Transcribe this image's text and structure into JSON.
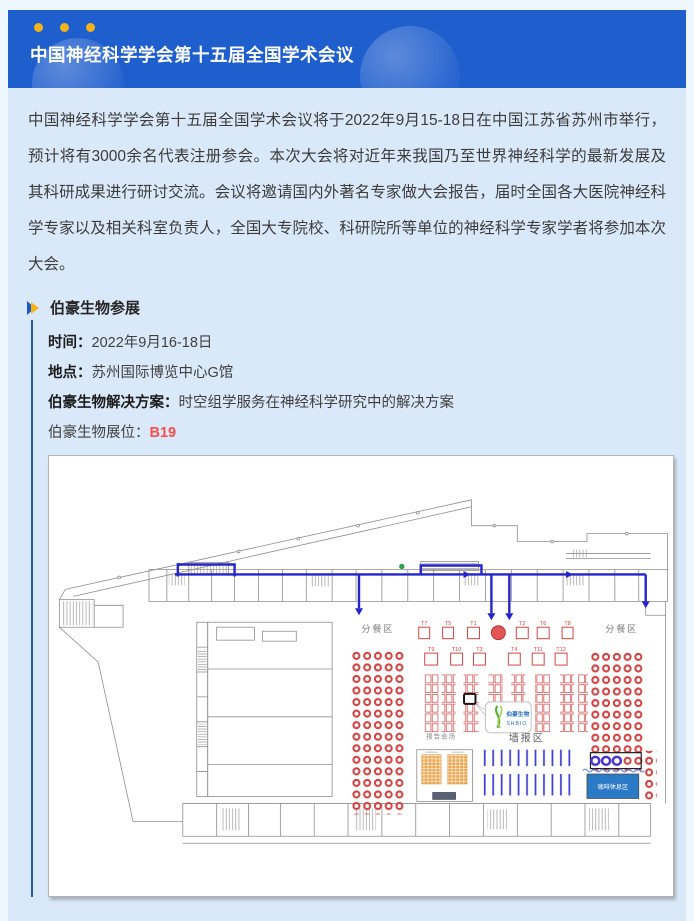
{
  "header": {
    "title": "中国神经科学学会第十五届全国学术会议"
  },
  "intro": {
    "text": "中国神经科学学会第十五届全国学术会议将于2022年9月15-18日在中国江苏省苏州市举行，预计将有3000余名代表注册参会。本次大会将对近年来我国乃至世界神经科学的最新发展及其科研成果进行研讨交流。会议将邀请国内外著名专家做大会报告，届时全国各大医院神经科学专家以及相关科室负责人，全国大专院校、科研院所等单位的神经科学专家学者将参加本次大会。"
  },
  "section": {
    "heading": "伯豪生物参展",
    "rows": [
      {
        "label": "时间：",
        "value": "2022年9月16-18日"
      },
      {
        "label": "地点：",
        "value": "苏州国际博览中心G馆"
      },
      {
        "label": "伯豪生物解决方案：",
        "value": "时空组学服务在神经科学研究中的解决方案"
      },
      {
        "label": "伯豪生物展位：",
        "value": "B19"
      }
    ]
  },
  "map": {
    "labels": {
      "dining_left": "分餐区",
      "dining_right": "分餐区",
      "lecture_hall": "报告会场",
      "poster_area": "墙报区",
      "coffee_area": "咖啡休息区"
    },
    "booth_row1": [
      "T7",
      "T5",
      "T1",
      "T2",
      "T6",
      "T8"
    ],
    "booth_row2": [
      "T9",
      "T10",
      "T3",
      "T4",
      "T11",
      "T12"
    ],
    "logo": {
      "name": "伯豪生物",
      "sub": "SHBIO"
    }
  },
  "colors": {
    "banner_blue": "#1f5ecd",
    "content_bg": "#d9e9fa",
    "accent_line": "#1d5c9e",
    "booth_no_red": "#fa4c4c",
    "route_blue": "#2424cb",
    "map_red": "#d04545",
    "dot_yellow": "#f2b31b"
  }
}
